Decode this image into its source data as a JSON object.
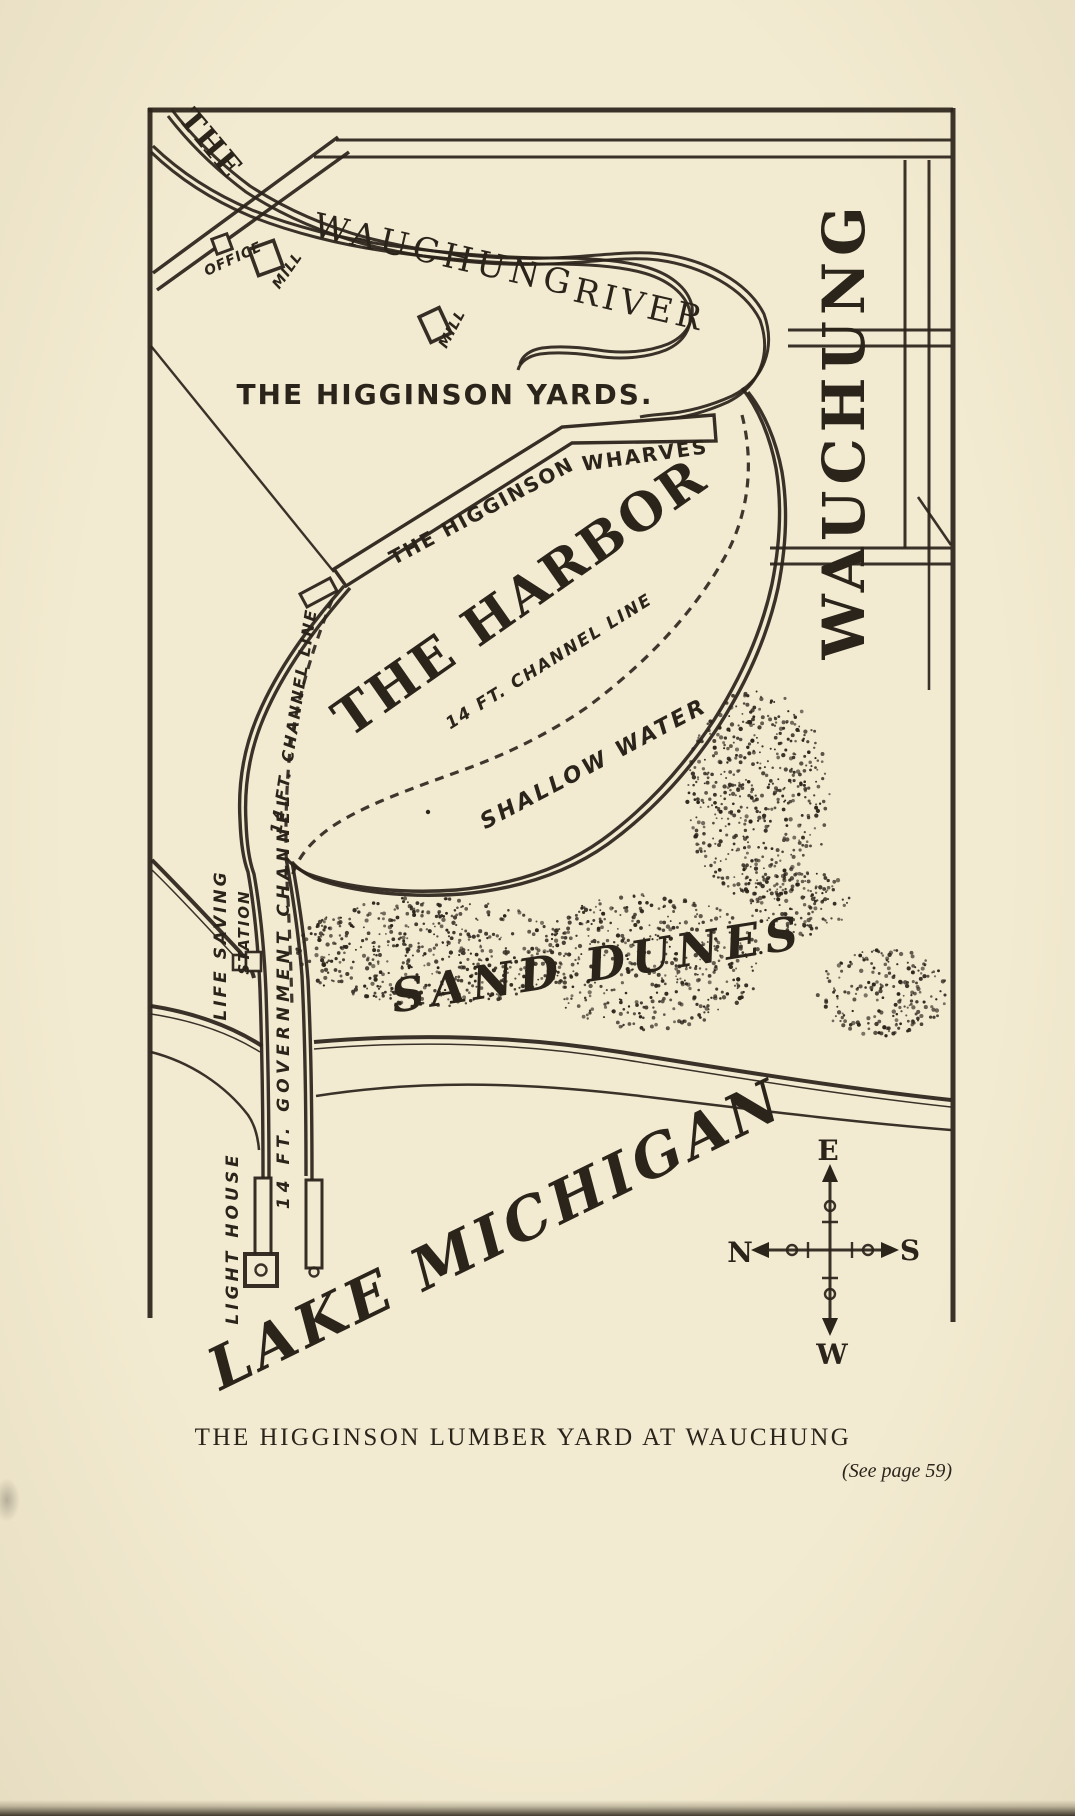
{
  "page": {
    "caption": "THE HIGGINSON LUMBER YARD AT WAUCHUNG",
    "page_ref": "(See page 59)",
    "paper_color": "#f3ebd1",
    "ink_color": "#2b241b"
  },
  "map": {
    "river_prefix": "THE",
    "river_name": "WAUCHUNG",
    "river_word": "RIVER",
    "office": "OFFICE",
    "mill_upper": "MILL",
    "mill_lower": "MILL",
    "yards": "THE HIGGINSON YARDS.",
    "wharves_line1": "THE HIGGINSON",
    "wharves_line2": "WHARVES",
    "harbor": "THE HARBOR",
    "channel_line_inner": "14 FT. CHANNEL LINE",
    "channel_line_west": "14 FT. CHANNEL LINE",
    "shallow_water": "SHALLOW WATER",
    "sand_dunes": "SAND DUNES",
    "life_saving_line1": "LIFE SAVING",
    "life_saving_line2": "STATION",
    "government_channel": "14 FT. GOVERNMENT CHANNEL",
    "light_house": "LIGHT HOUSE",
    "lake": "LAKE MICHIGAN",
    "town": "WAUCHUNG",
    "compass": {
      "up": "E",
      "left": "N",
      "right": "S",
      "down": "W"
    }
  }
}
